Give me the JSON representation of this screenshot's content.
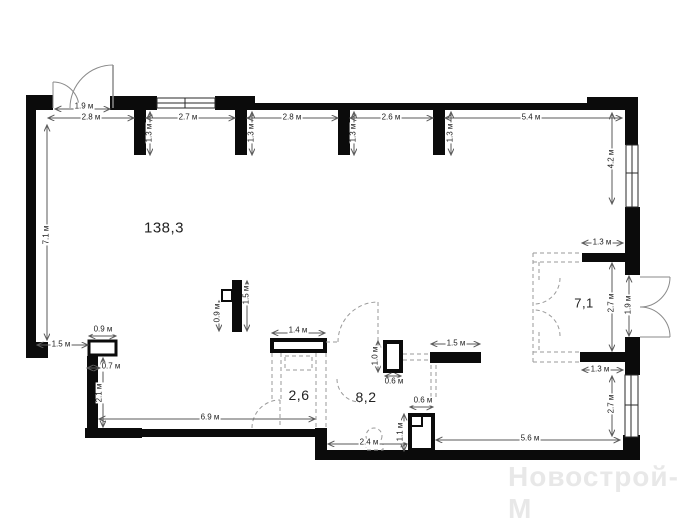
{
  "plan": {
    "type": "floor_plan",
    "unit": "м",
    "watermark": "Новострой-М",
    "rooms": [
      {
        "name": "main-space",
        "area": "138,3"
      },
      {
        "name": "bathroom",
        "area": "2,6"
      },
      {
        "name": "hall",
        "area": "8,2"
      },
      {
        "name": "dressing",
        "area": "7,1"
      }
    ],
    "dimensions": [
      {
        "text": "1.9 м"
      },
      {
        "text": "2.8 м"
      },
      {
        "text": "2.7 м"
      },
      {
        "text": "2.8 м"
      },
      {
        "text": "2.6 м"
      },
      {
        "text": "5.4 м"
      },
      {
        "text": "1.3 м"
      },
      {
        "text": "1.3 м"
      },
      {
        "text": "1.3 м"
      },
      {
        "text": "1.3 м"
      },
      {
        "text": "4.2 м"
      },
      {
        "text": "7.1 м"
      },
      {
        "text": "1.3 м"
      },
      {
        "text": "2.7 м"
      },
      {
        "text": "1.9 м"
      },
      {
        "text": "1.3 м"
      },
      {
        "text": "2.7 м"
      },
      {
        "text": "0.9 м"
      },
      {
        "text": "1.5 м"
      },
      {
        "text": "0.7 м"
      },
      {
        "text": "2.1 м"
      },
      {
        "text": "0.9 м"
      },
      {
        "text": "1.5 м"
      },
      {
        "text": "1.4 м"
      },
      {
        "text": "6.9 м"
      },
      {
        "text": "1.0 м"
      },
      {
        "text": "0.6 м"
      },
      {
        "text": "1.5 м"
      },
      {
        "text": "0.6 м"
      },
      {
        "text": "1.1 м"
      },
      {
        "text": "2.4 м"
      },
      {
        "text": "5.6 м"
      }
    ],
    "colors": {
      "walls": "#0b0b0b",
      "dimension_lines": "#5a5a5a",
      "dimension_text": "#1c1c1c",
      "dashed_elements": "#9a9a9a",
      "door_arcs": "#8a8a8a",
      "watermark": "#e8e8e8",
      "background": "#ffffff"
    }
  }
}
